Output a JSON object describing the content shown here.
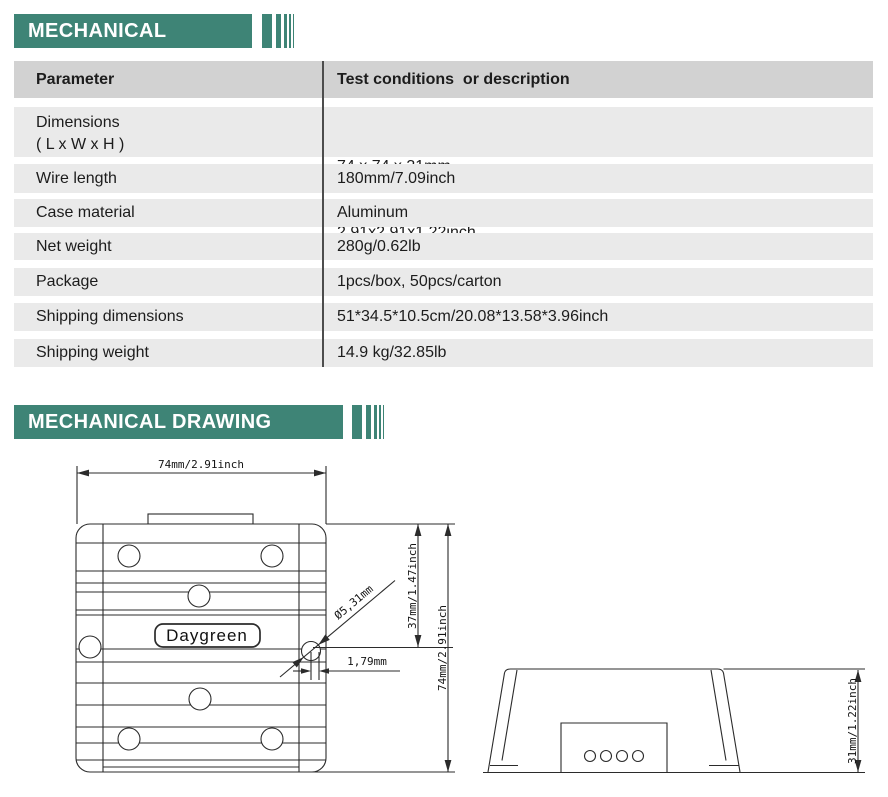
{
  "colors": {
    "accent": "#3E8476",
    "table_header_bg": "#D2D2D2",
    "row_bg": "#EAEAEA",
    "divider": "#4D4D4D",
    "line": "#2B2B2B"
  },
  "section_mechanical": {
    "title": "MECHANICAL"
  },
  "section_drawing": {
    "title": "MECHANICAL DRAWING"
  },
  "table": {
    "col1_header": "Parameter",
    "col2_header": "Test conditions  or description",
    "rows": [
      {
        "param": [
          "Dimensions",
          "( L x W x H )"
        ],
        "value": [
          "74 x 74 x 31mm",
          "2.91x2.91x1.22inch"
        ]
      },
      {
        "param": [
          "Wire length"
        ],
        "value": [
          "180mm/7.09inch"
        ]
      },
      {
        "param": [
          "Case material"
        ],
        "value": [
          "Aluminum"
        ]
      },
      {
        "param": [
          "Net weight"
        ],
        "value": [
          "280g/0.62lb"
        ]
      },
      {
        "param": [
          "Package"
        ],
        "value": [
          "1pcs/box, 50pcs/carton"
        ]
      },
      {
        "param": [
          "Shipping dimensions"
        ],
        "value": [
          "51*34.5*10.5cm/20.08*13.58*3.96inch"
        ]
      },
      {
        "param": [
          "Shipping weight"
        ],
        "value": [
          "14.9 kg/32.85lb"
        ]
      }
    ]
  },
  "drawing": {
    "brand_label": "Daygreen",
    "top_view": {
      "width_dim": "74mm/2.91inch",
      "height_dim": "74mm/2.91inch",
      "hole_vertical_dim": "37mm/1.47inch",
      "hole_diameter_dim": "Ø5,31mm",
      "hole_horizontal_dim": "1,79mm"
    },
    "side_view": {
      "height_dim": "31mm/1.22inch"
    }
  }
}
